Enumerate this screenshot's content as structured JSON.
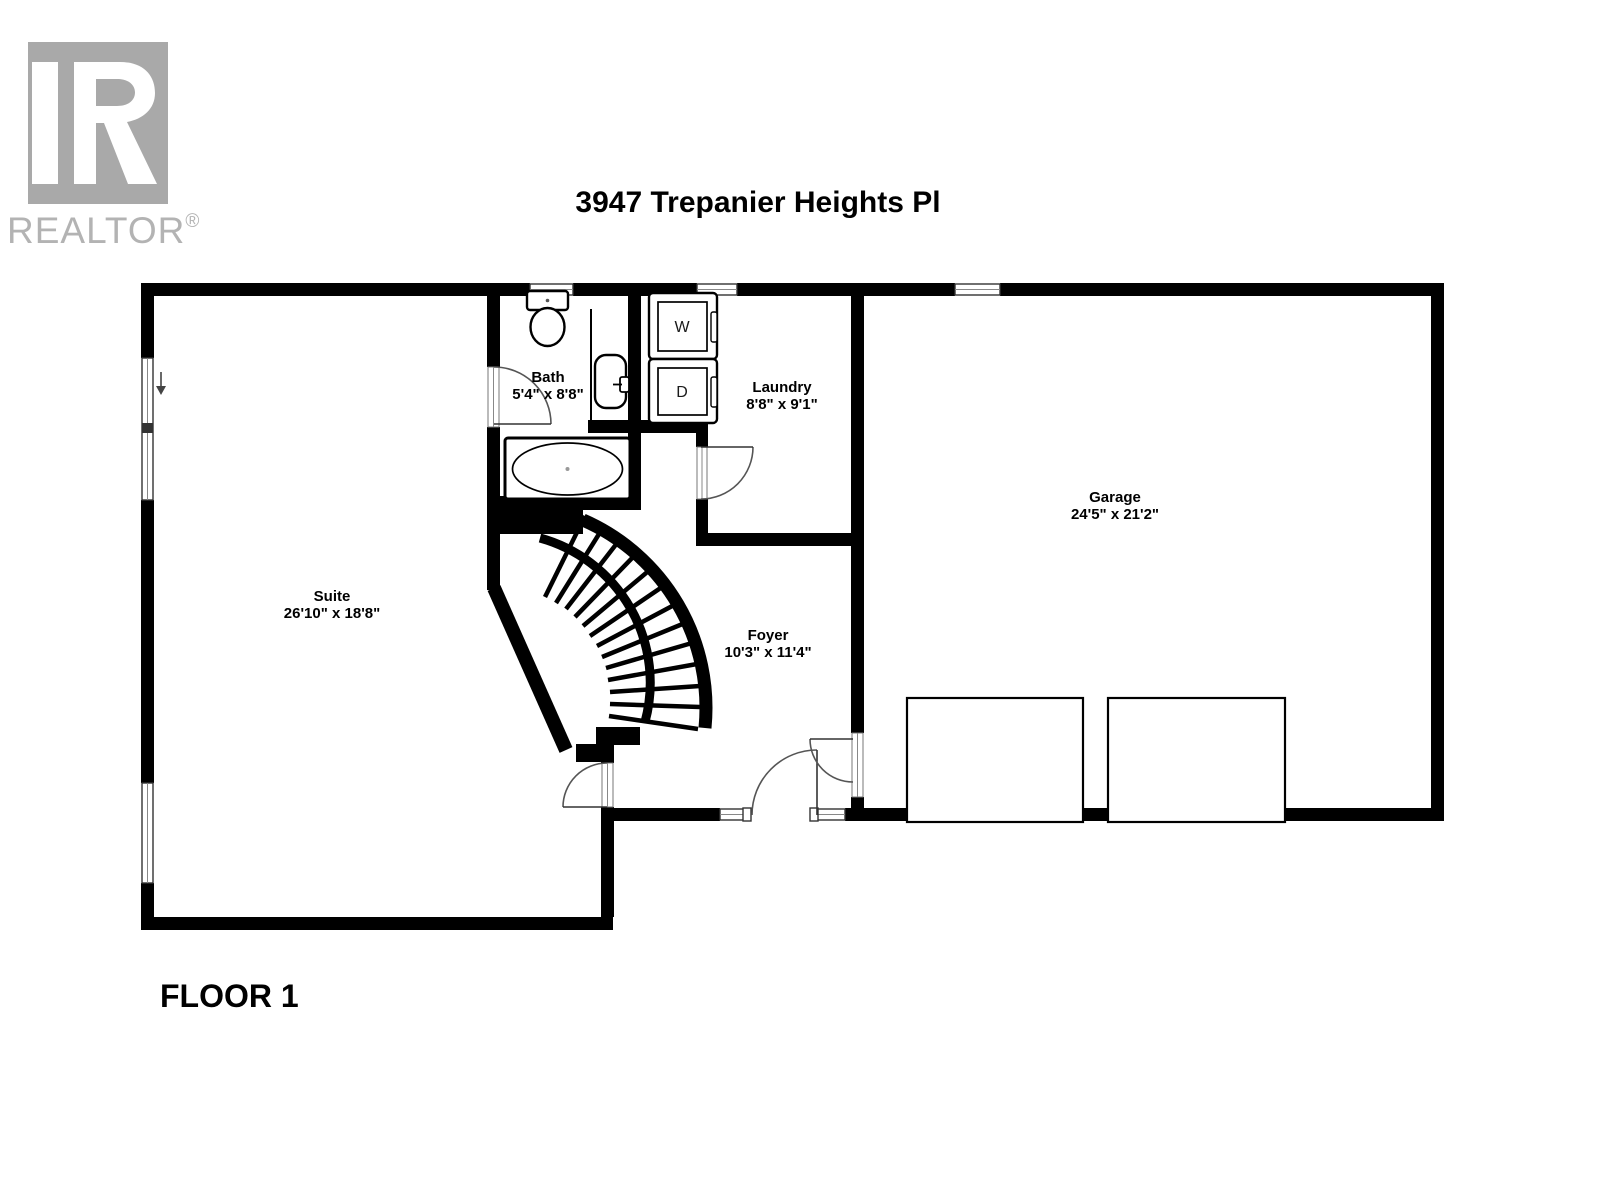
{
  "brand": {
    "name": "REALTOR",
    "registered": "®"
  },
  "header": {
    "title": "3947 Trepanier Heights Pl"
  },
  "floor": {
    "label": "FLOOR 1"
  },
  "rooms": {
    "suite": {
      "name": "Suite",
      "dims": "26'10\" x 18'8\""
    },
    "bath": {
      "name": "Bath",
      "dims": "5'4\" x 8'8\""
    },
    "laundry": {
      "name": "Laundry",
      "dims": "8'8\" x 9'1\""
    },
    "garage": {
      "name": "Garage",
      "dims": "24'5\" x 21'2\""
    },
    "foyer": {
      "name": "Foyer",
      "dims": "10'3\" x 11'4\""
    }
  },
  "appliances": {
    "washer_label": "W",
    "dryer_label": "D"
  },
  "colors": {
    "wall": "#000000",
    "background": "#ffffff",
    "logo_gray": "#a9a9a9",
    "logo_text_gray": "#b3b3b3",
    "door_arc": "#555555"
  }
}
